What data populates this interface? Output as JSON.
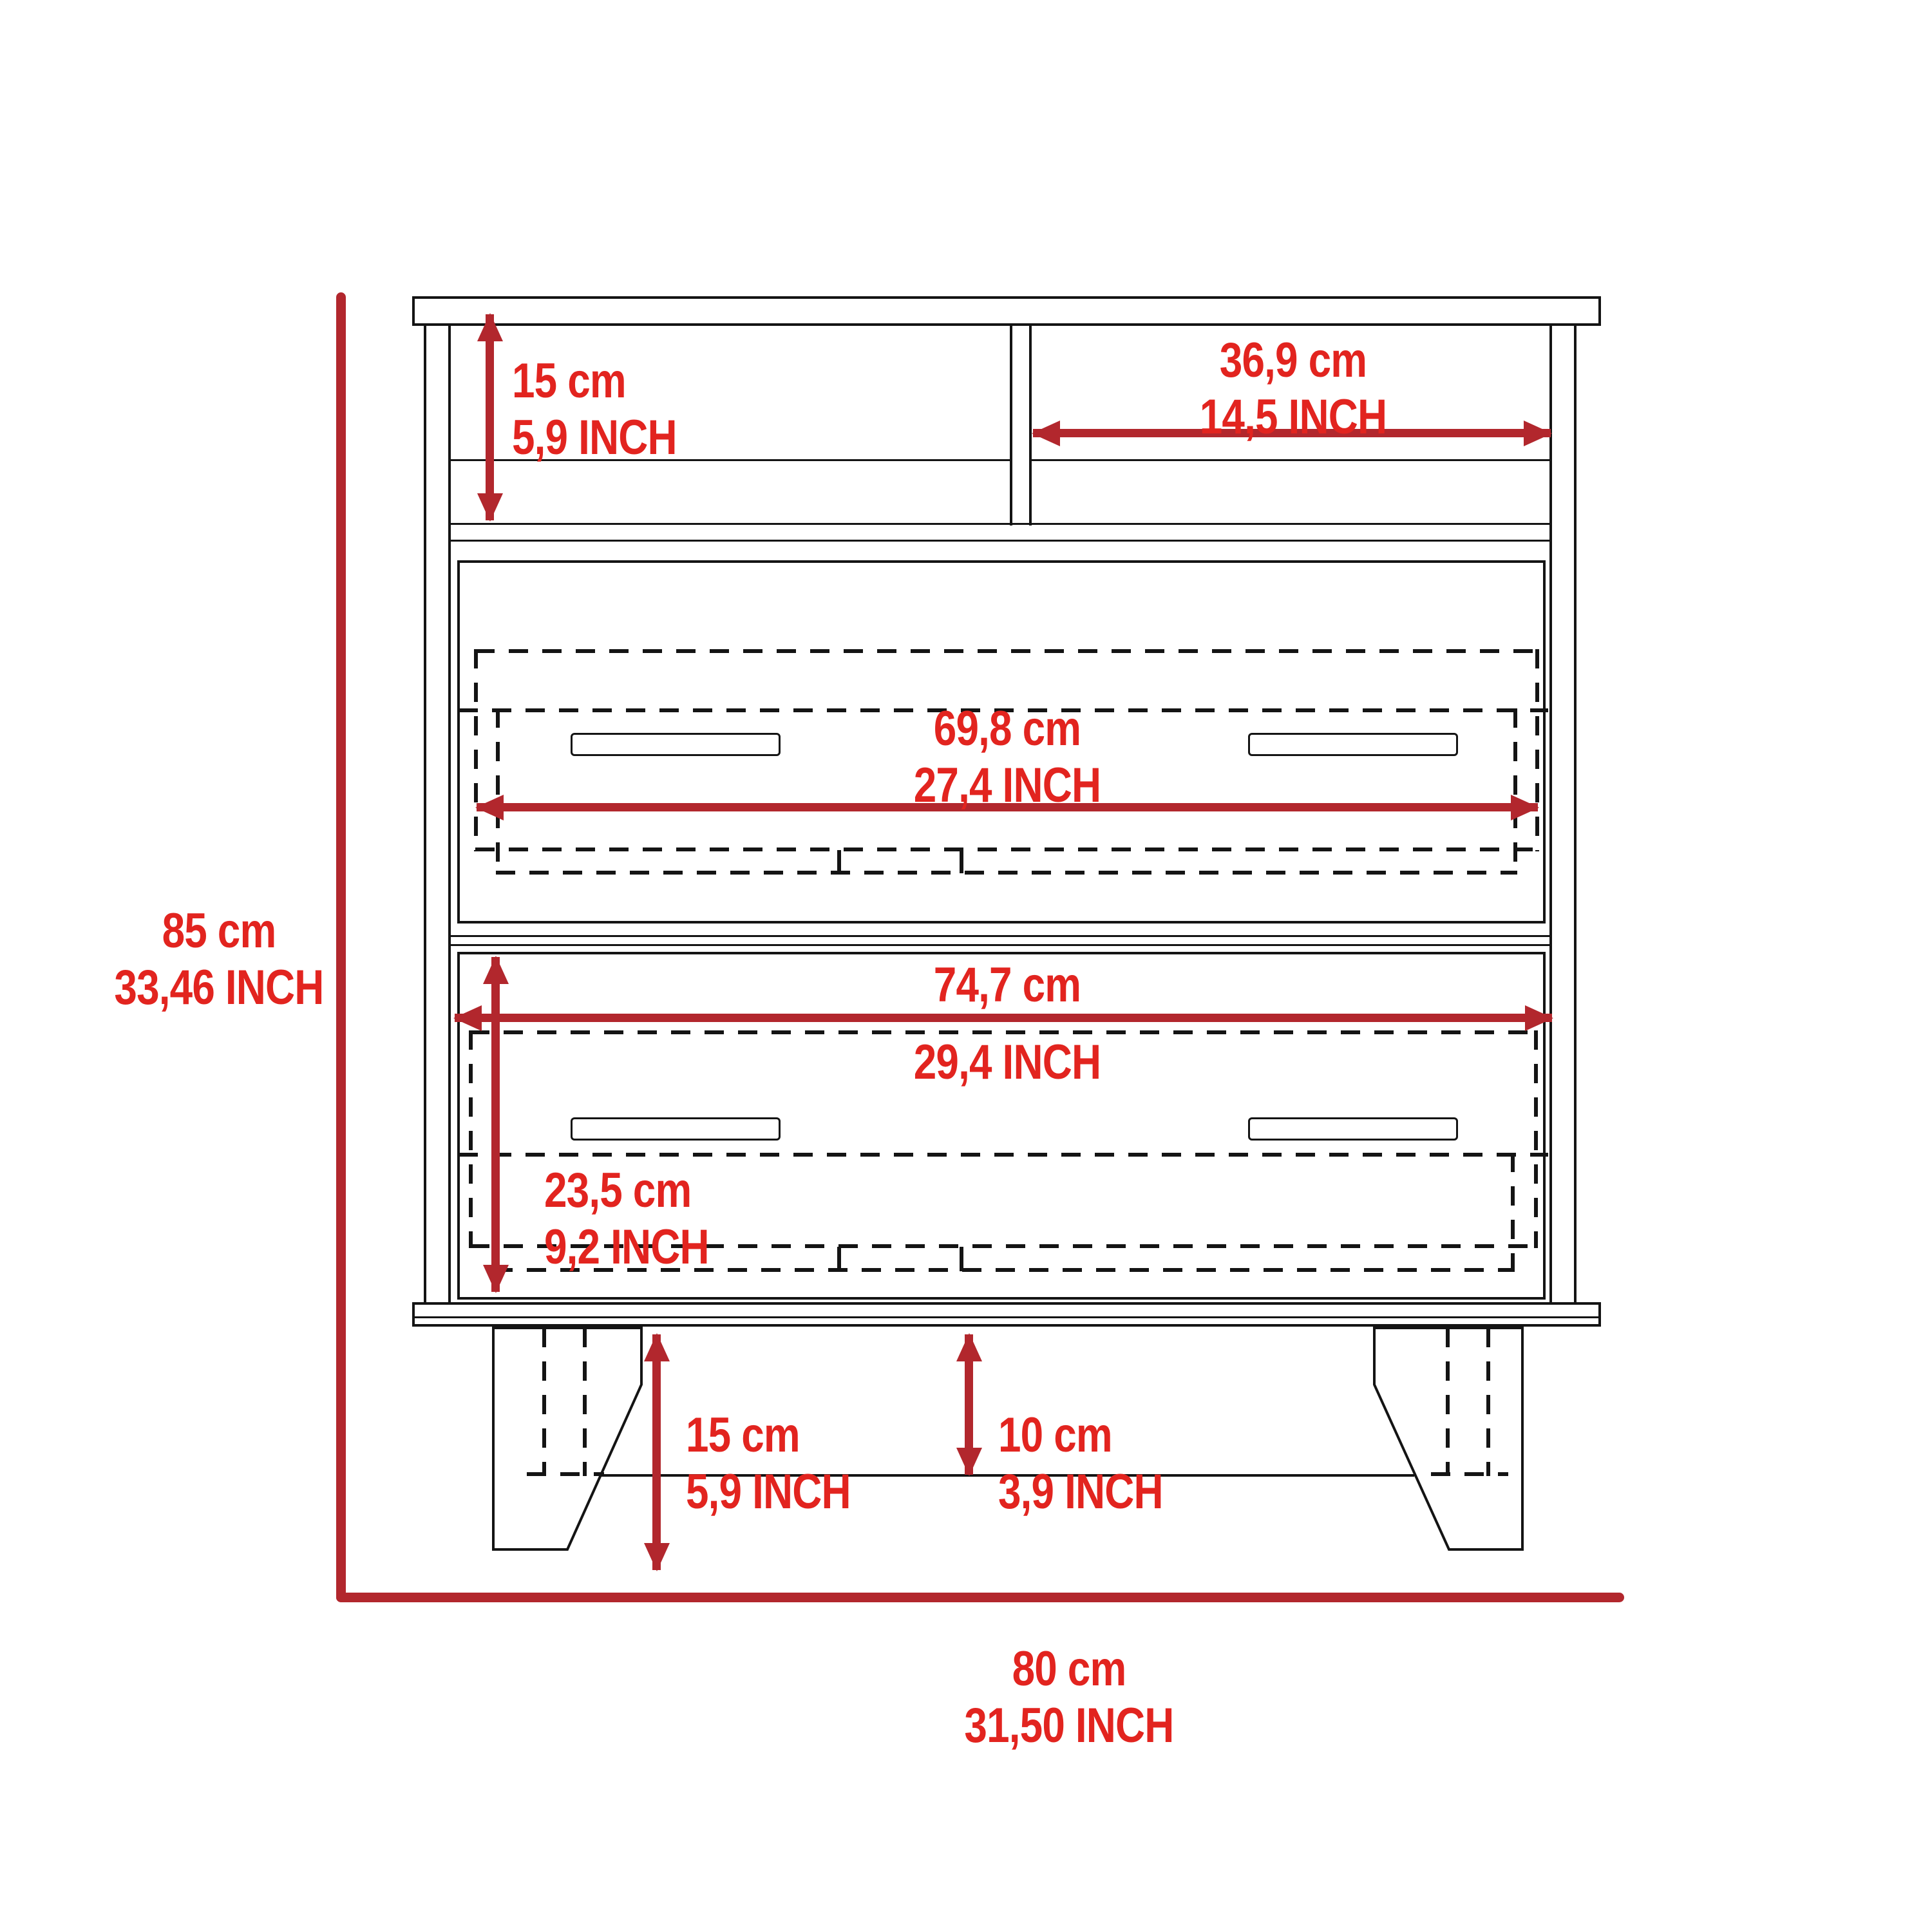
{
  "diagram": {
    "type": "furniture-dimension-drawing",
    "subject": "Front elevation of a two-drawer dresser with top open shelves and angled legs, annotated with metric and imperial dimensions",
    "colors": {
      "outline": "#141414",
      "dimension_line": "#b2272d",
      "dimension_text": "#e2241f",
      "background": "#ffffff"
    }
  },
  "dims": {
    "shelf_height": {
      "cm": "15 cm",
      "inch": "5,9 INCH"
    },
    "shelf_width": {
      "cm": "36,9 cm",
      "inch": "14,5 INCH"
    },
    "drawer_top_width": {
      "cm": "69,8 cm",
      "inch": "27,4 INCH"
    },
    "drawer_bottom_width": {
      "cm": "74,7 cm",
      "inch": "29,4 INCH"
    },
    "drawer_bottom_height": {
      "cm": "23,5 cm",
      "inch": "9,2 INCH"
    },
    "leg_height": {
      "cm": "15 cm",
      "inch": "5,9 INCH"
    },
    "floor_clearance": {
      "cm": "10 cm",
      "inch": "3,9 INCH"
    },
    "overall_height": {
      "cm": "85 cm",
      "inch": "33,46 INCH"
    },
    "overall_width": {
      "cm": "80 cm",
      "inch": "31,50 INCH"
    }
  }
}
